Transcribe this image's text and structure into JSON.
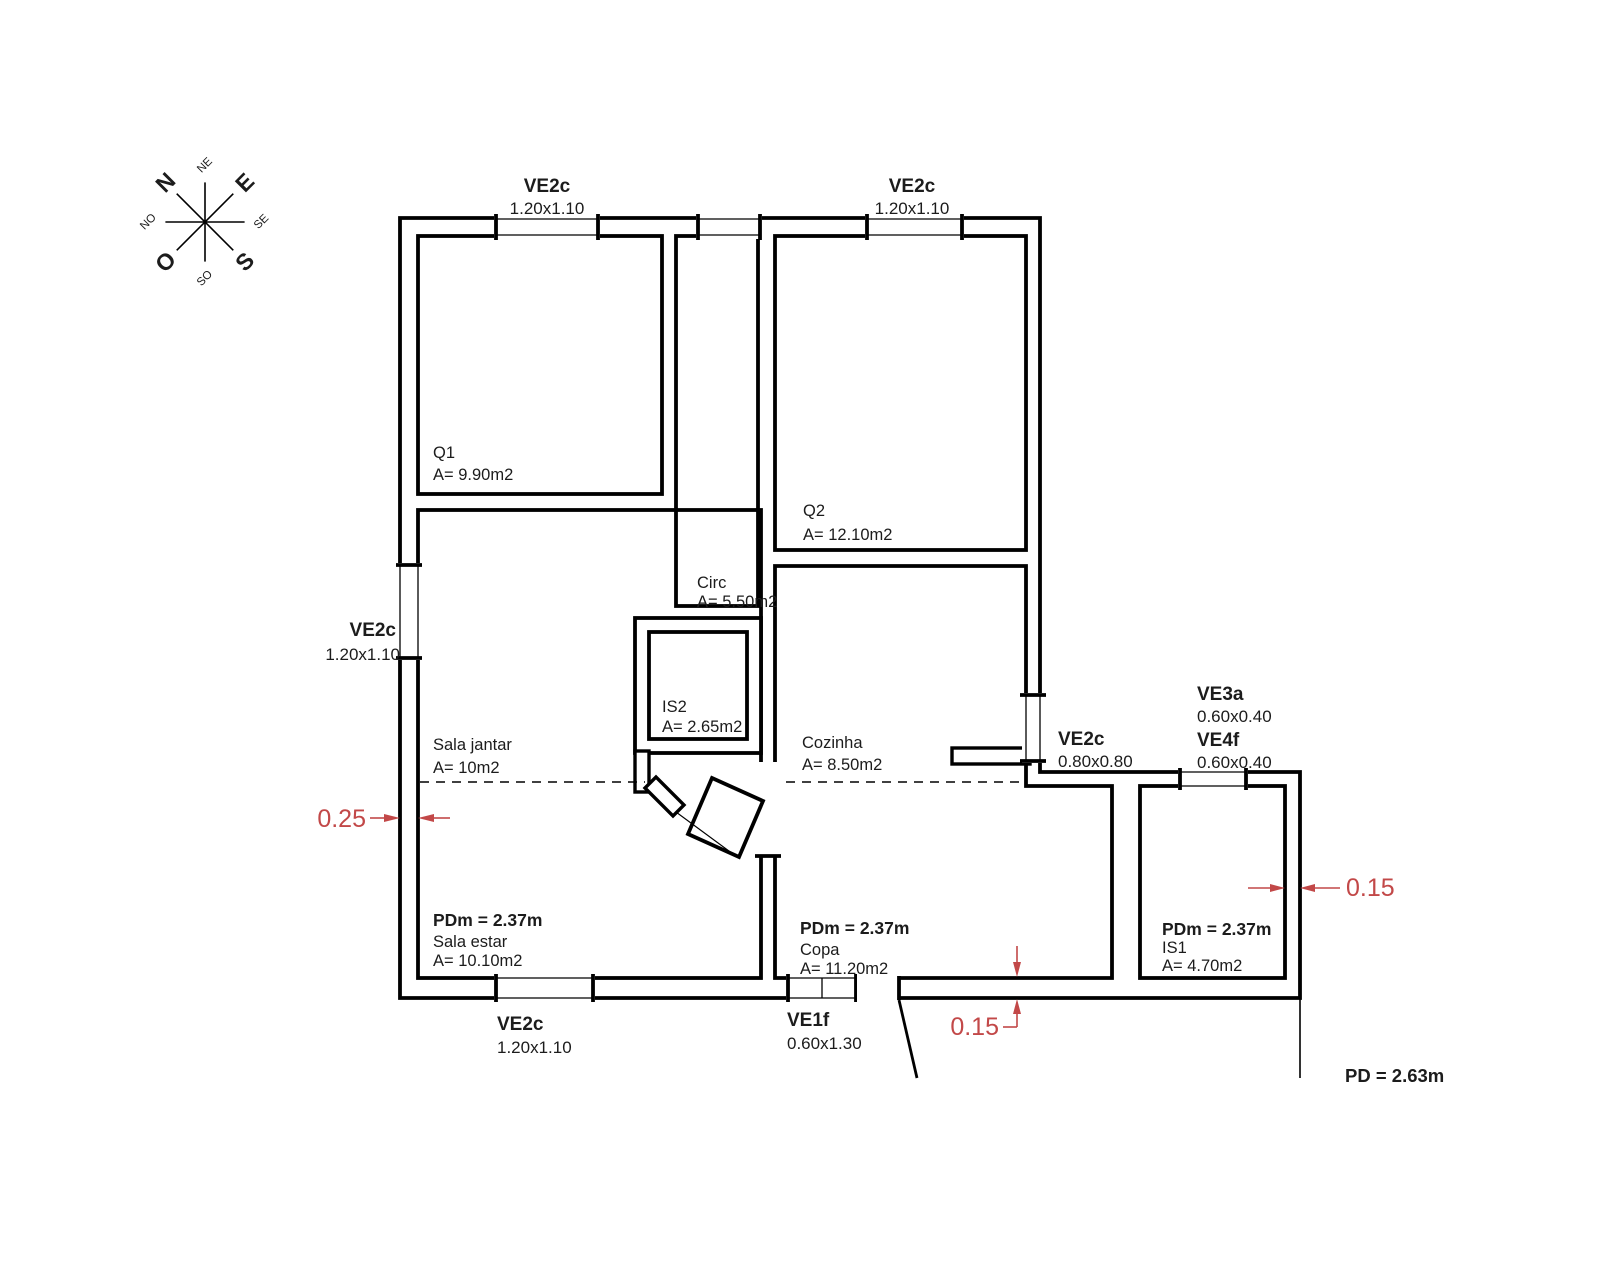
{
  "compass": {
    "n": "N",
    "e": "E",
    "s": "S",
    "o": "O",
    "ne": "NE",
    "se": "SE",
    "so": "SO",
    "no": "NO"
  },
  "windows": {
    "top_left": {
      "label": "VE2c",
      "size": "1.20x1.10"
    },
    "top_right": {
      "label": "VE2c",
      "size": "1.20x1.10"
    },
    "left": {
      "label": "VE2c",
      "size": "1.20x1.10"
    },
    "bottom": {
      "label": "VE2c",
      "size": "1.20x1.10"
    },
    "bottom_door": {
      "label": "VE1f",
      "size": "0.60x1.30"
    },
    "right": {
      "label": "VE2c",
      "size": "0.80x0.80"
    },
    "annex_a": {
      "label": "VE3a",
      "size": "0.60x0.40"
    },
    "annex_b": {
      "label": "VE4f",
      "size": "0.60x0.40"
    }
  },
  "rooms": {
    "q1": {
      "name": "Q1",
      "area": "A= 9.90m2"
    },
    "q2": {
      "name": "Q2",
      "area": "A= 12.10m2"
    },
    "circ": {
      "name": "Circ",
      "area": "A= 5.50m2"
    },
    "is2": {
      "name": "IS2",
      "area": "A= 2.65m2"
    },
    "sala_jantar": {
      "name": "Sala jantar",
      "area": "A= 10m2"
    },
    "cozinha": {
      "name": "Cozinha",
      "area": "A= 8.50m2"
    },
    "sala_estar": {
      "name": "Sala estar",
      "area": "A= 10.10m2",
      "pdm": "PDm = 2.37m"
    },
    "copa": {
      "name": "Copa",
      "area": "A= 11.20m2",
      "pdm": "PDm = 2.37m"
    },
    "is1": {
      "name": "IS1",
      "area": "A= 4.70m2",
      "pdm": "PDm = 2.37m"
    }
  },
  "dimensions": {
    "wall_left": "0.25",
    "wall_bottom": "0.15",
    "wall_right": "0.15"
  },
  "notes": {
    "ceiling_height": "PD = 2.63m"
  },
  "colors": {
    "dimension": "#c24848",
    "line": "#000000"
  }
}
